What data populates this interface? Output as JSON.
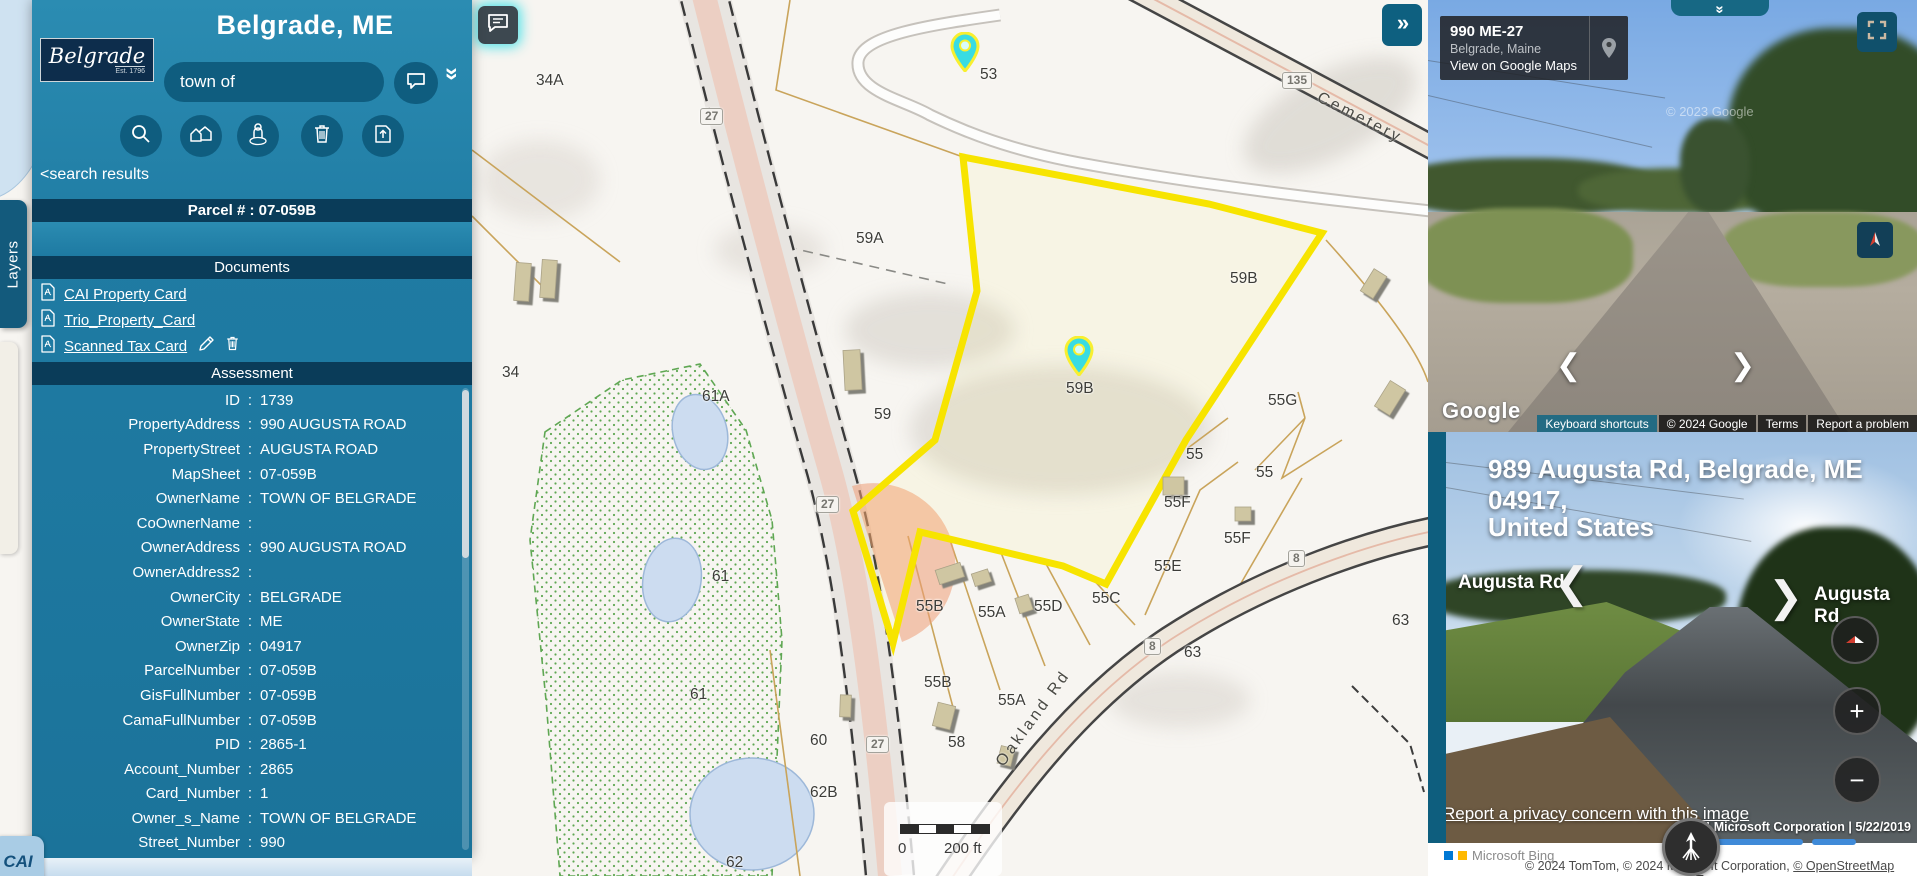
{
  "app": {
    "town_title": "Belgrade, ME",
    "logo_line1": "Belgrade",
    "logo_line2": "Est. 1796",
    "layers_tab": "Layers",
    "cai_badge": "CAI"
  },
  "sidebar": {
    "search_value": "town of",
    "back_link": "<search results",
    "parcel_header": "Parcel # : 07-059B",
    "documents_header": "Documents",
    "documents": [
      {
        "label": "CAI Property Card"
      },
      {
        "label": "Trio_Property_Card"
      },
      {
        "label": "Scanned Tax Card"
      }
    ],
    "assessment_header": "Assessment",
    "colon": ":",
    "collapse_glyph": "«",
    "assessment_rows": [
      {
        "label": "ID",
        "value": "1739"
      },
      {
        "label": "PropertyAddress",
        "value": "990 AUGUSTA ROAD"
      },
      {
        "label": "PropertyStreet",
        "value": "AUGUSTA ROAD"
      },
      {
        "label": "MapSheet",
        "value": "07-059B"
      },
      {
        "label": "OwnerName",
        "value": "TOWN OF BELGRADE"
      },
      {
        "label": "CoOwnerName",
        "value": ""
      },
      {
        "label": "OwnerAddress",
        "value": "990 AUGUSTA ROAD"
      },
      {
        "label": "OwnerAddress2",
        "value": ""
      },
      {
        "label": "OwnerCity",
        "value": "BELGRADE"
      },
      {
        "label": "OwnerState",
        "value": "ME"
      },
      {
        "label": "OwnerZip",
        "value": "04917"
      },
      {
        "label": "ParcelNumber",
        "value": "07-059B"
      },
      {
        "label": "GisFullNumber",
        "value": "07-059B"
      },
      {
        "label": "CamaFullNumber",
        "value": "07-059B"
      },
      {
        "label": "PID",
        "value": "2865-1"
      },
      {
        "label": "Account_Number",
        "value": "2865"
      },
      {
        "label": "Card_Number",
        "value": "1"
      },
      {
        "label": "Owner_s_Name",
        "value": "TOWN OF BELGRADE"
      },
      {
        "label": "Street_Number",
        "value": "990"
      }
    ]
  },
  "map": {
    "expand_button": "»",
    "road_cemetery": "Cemetery",
    "road_oakland": "Oakland Rd",
    "scale_zero": "0",
    "scale_label": "200 ft",
    "labels": [
      {
        "t": "34A",
        "x": 536,
        "y": 72
      },
      {
        "t": "53",
        "x": 980,
        "y": 66
      },
      {
        "t": "59A",
        "x": 856,
        "y": 230
      },
      {
        "t": "59B",
        "x": 1230,
        "y": 270
      },
      {
        "t": "59B",
        "x": 1066,
        "y": 380
      },
      {
        "t": "59",
        "x": 874,
        "y": 406
      },
      {
        "t": "34",
        "x": 502,
        "y": 364
      },
      {
        "t": "61A",
        "x": 702,
        "y": 388
      },
      {
        "t": "61",
        "x": 712,
        "y": 568
      },
      {
        "t": "61",
        "x": 690,
        "y": 686
      },
      {
        "t": "55G",
        "x": 1268,
        "y": 392
      },
      {
        "t": "55",
        "x": 1186,
        "y": 446
      },
      {
        "t": "55",
        "x": 1256,
        "y": 464
      },
      {
        "t": "55F",
        "x": 1164,
        "y": 494
      },
      {
        "t": "55F",
        "x": 1224,
        "y": 530
      },
      {
        "t": "55E",
        "x": 1154,
        "y": 558
      },
      {
        "t": "55D",
        "x": 1034,
        "y": 598
      },
      {
        "t": "55C",
        "x": 1092,
        "y": 590
      },
      {
        "t": "55B",
        "x": 916,
        "y": 598
      },
      {
        "t": "55A",
        "x": 978,
        "y": 604
      },
      {
        "t": "55B",
        "x": 924,
        "y": 674
      },
      {
        "t": "55A",
        "x": 998,
        "y": 692
      },
      {
        "t": "63",
        "x": 1392,
        "y": 612
      },
      {
        "t": "63",
        "x": 1184,
        "y": 644
      },
      {
        "t": "58",
        "x": 948,
        "y": 734
      },
      {
        "t": "60",
        "x": 810,
        "y": 732
      },
      {
        "t": "62B",
        "x": 810,
        "y": 784
      },
      {
        "t": "62",
        "x": 726,
        "y": 854
      }
    ],
    "shields": [
      {
        "t": "27",
        "x": 700,
        "y": 108
      },
      {
        "t": "27",
        "x": 816,
        "y": 496
      },
      {
        "t": "27",
        "x": 866,
        "y": 736
      },
      {
        "t": "135",
        "x": 1282,
        "y": 72
      },
      {
        "t": "8",
        "x": 1288,
        "y": 550
      },
      {
        "t": "8",
        "x": 1144,
        "y": 638
      }
    ]
  },
  "gsv": {
    "address_title": "990 ME-27",
    "address_city": "Belgrade, Maine",
    "address_link": "View on Google Maps",
    "collapse_glyph": "»",
    "watermark": "© 2023 Google",
    "logo": "Google",
    "keyboard_shortcuts": "Keyboard shortcuts",
    "copyright": "© 2024 Google",
    "terms": "Terms",
    "report": "Report a problem",
    "prev_arrow": "❮",
    "next_arrow": "❯"
  },
  "streetside": {
    "address_line1": "989 Augusta Rd, Belgrade, ME 04917,",
    "address_line2": "United States",
    "road_left": "Augusta Rd",
    "road_right": "Augusta Rd",
    "prev_arrow": "❮",
    "next_arrow": "❯",
    "zoom_in": "+",
    "zoom_out": "−",
    "privacy_link": "Report a privacy concern with this image",
    "copyright": "©2024 Microsoft Corporation | 5/22/2019"
  },
  "footer": {
    "bing_logo": "Microsoft Bing",
    "attribution": "© 2024 TomTom, © 2024 Microsoft Corporation,",
    "osm_link": "© OpenStreetMap",
    "terms_link": "Terms"
  },
  "colors": {
    "sidebar_teal": "#1f7ba3",
    "header_navy": "#0a3c59",
    "highlight_yellow": "#f7e400",
    "pin_cyan": "#39dce2"
  }
}
